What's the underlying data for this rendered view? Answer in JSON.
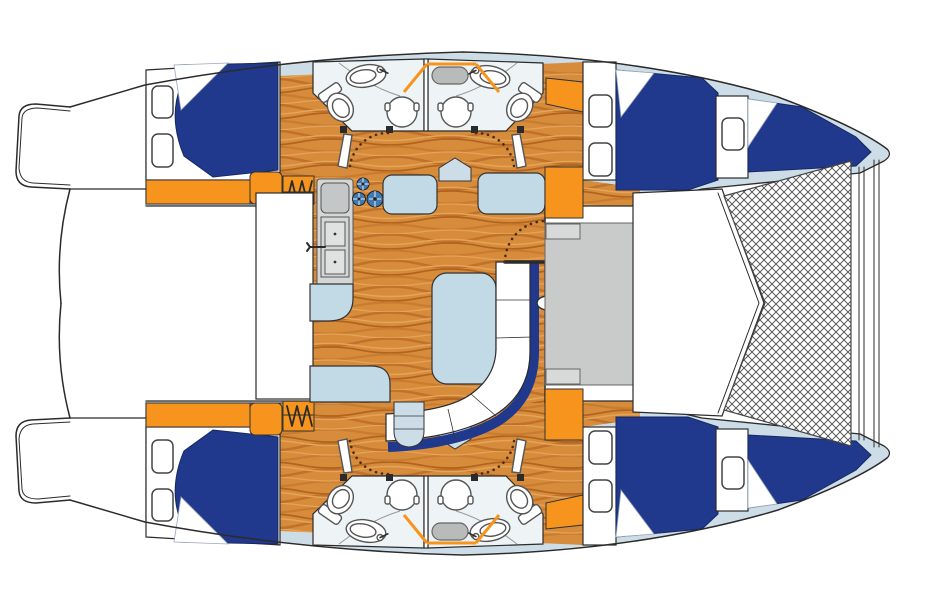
{
  "diagram": {
    "type": "yacht-floor-plan",
    "vessel": "catamaran",
    "view": "top-down-deck-plan"
  },
  "palette": {
    "outline": "#2b2b2b",
    "hull-white": "#ffffff",
    "deck": "#ccdde8",
    "head": "#eef3f6",
    "seat": "#c2d9e6",
    "navy": "#20398c",
    "orange": "#f7941d",
    "wood-base": "#d78c3c",
    "wood-grain": "#b2641f",
    "counter-gray": "#d5d7d7",
    "cockpit-gray": "#c9cbcb",
    "hatch-gray": "#b9bbbb",
    "mesh-line": "#4a4a4a"
  },
  "regions": {
    "aft_cabins": 2,
    "forward_cabins": 2,
    "bow_cabins": 2,
    "heads": 4,
    "salon": 1,
    "galley": 1,
    "forward_cockpit": 1,
    "trampoline": 1
  },
  "fixtures": {
    "berths": 6,
    "toilets": 4,
    "sinks": 4,
    "shower_stalls": 4,
    "stove_burners": 3,
    "companionway_steps": 2,
    "deck_hatches": 2,
    "doors": 6
  }
}
